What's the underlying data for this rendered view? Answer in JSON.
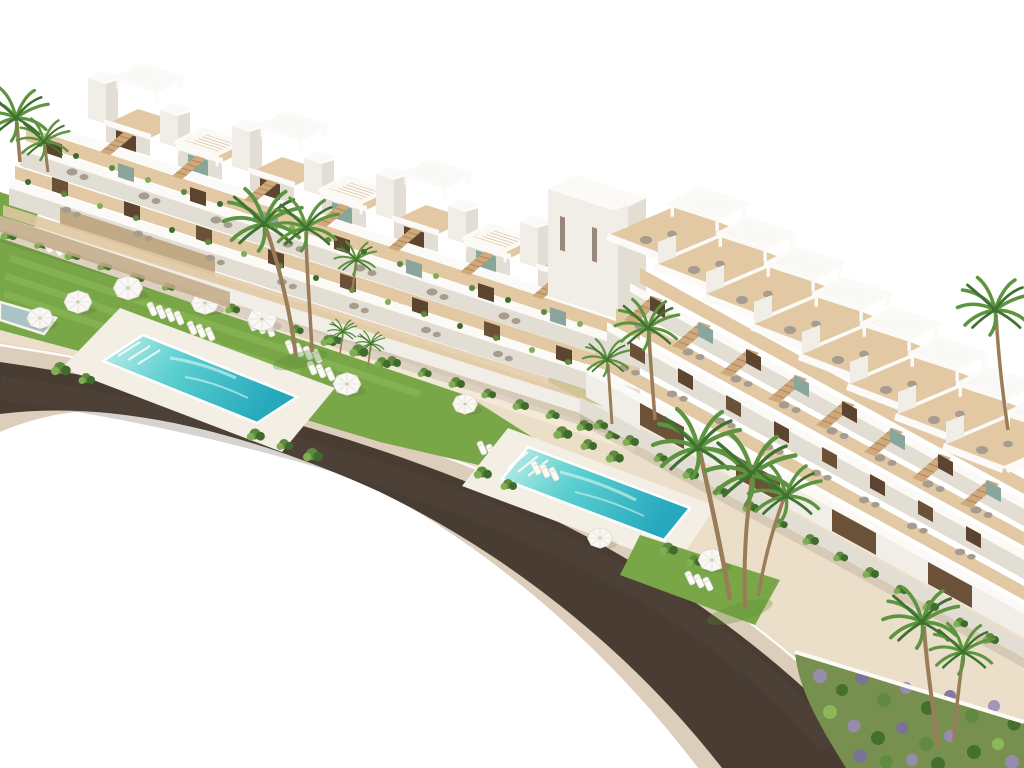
{
  "scene": {
    "title": "Aerial 3D architectural rendering of a modern white terraced apartment complex",
    "description": "Bird's-eye render of two stepped white residential blocks with rooftop pergolas and wood sun decks, terraces with grey loungers, landscaped gardens with lawns, white parasols, sunbeds, palm trees, two turquoise lap pools, a purple-flower shrub bed, and a dark curved road with beige sidewalks sweeping across the lower left on a pure white background.",
    "style": "photoreal CGI, bright daylight, white sky background"
  },
  "palette": {
    "bg": "#ffffff",
    "white1": "#fbfaf7",
    "white2": "#f1eee8",
    "white3": "#e3ded4",
    "white4": "#cfc8bb",
    "woodFloor": "#e2c9a4",
    "wood": "#cfa87b",
    "woodDark": "#ad865c",
    "stone": "#c2a986",
    "doorDark": "#5d4430",
    "doorWood": "#6a5138",
    "glass": "#8aa69c",
    "pouf": "#a69d90",
    "road": "#483c33",
    "roadLight": "#5d4f44",
    "sidewalk": "#ddcebc",
    "sidewalkLight": "#ecdfcc",
    "ground": "#ecdfc9",
    "groundLight": "#f4e9d6",
    "lawn": "#79a748",
    "lawnLight": "#8fbd5a",
    "lawnDark": "#5d8c36",
    "hedge": "#5d8a3f",
    "hedgeDark": "#3f6c2c",
    "hedgeLight": "#7fae54",
    "poolLight": "#c4f0e8",
    "poolMid": "#5bcfd0",
    "poolDeep": "#27a9bd",
    "deck": "#f3efe5",
    "smallPool": "#a9c3c6",
    "trunk": "#9b7c58",
    "frond": "#5d9440",
    "frondDark": "#3f7230",
    "purple": "#9a8cba",
    "purpleDark": "#7c6fa0",
    "umbrella": "#faf8f4",
    "shadow": "rgba(60,50,40,0.12)"
  },
  "objects": {
    "left_building": {
      "label": "left terraced block",
      "roof_units": 7,
      "end_tower": 1,
      "terrace_levels": 3,
      "features": [
        "rooftop pergolas",
        "wood roof decks",
        "diagonal stairs",
        "planters",
        "stone base wall"
      ]
    },
    "right_building": {
      "label": "right terraced block",
      "roof_units": 8,
      "terrace_levels": 3,
      "features": [
        "rooftop pergolas",
        "wood roof decks",
        "grey lounge poufs",
        "dark wood slat ground floor"
      ]
    },
    "pools": [
      {
        "label": "main lap pool",
        "area": "left garden"
      },
      {
        "label": "second lap pool",
        "area": "center garden"
      },
      {
        "label": "small edge pool",
        "area": "left image edge"
      }
    ],
    "road": {
      "label": "curved asphalt road with beige sidewalks"
    },
    "landscape": {
      "lawns": 3,
      "umbrellas": 9,
      "sun_lounger_rows": 10,
      "palm_clusters": 8,
      "shrub_hedges": 6,
      "flower_bed": "purple-green shrub bed bottom right"
    }
  }
}
